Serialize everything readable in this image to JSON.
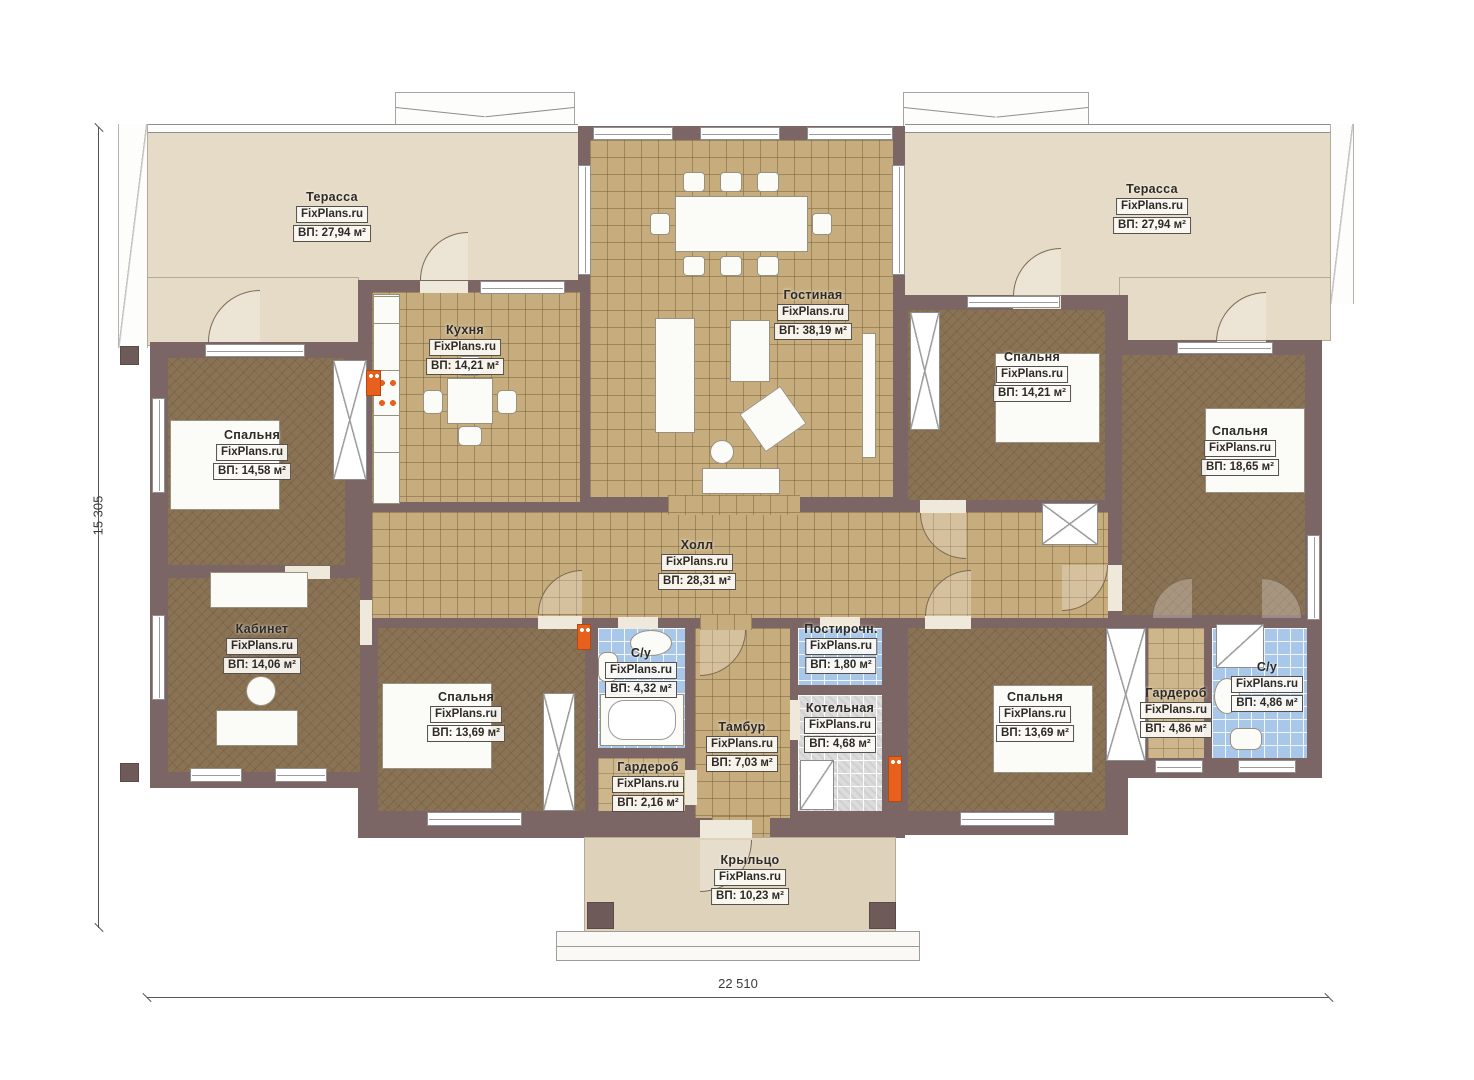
{
  "brand": "FixPlans.ru",
  "dimensions": {
    "width_label": "22 510",
    "height_label": "15 305"
  },
  "colors": {
    "wall": "#7c6565",
    "terrace_floor": "#e6dbc6",
    "tile_floor": "#c7ad7e",
    "room_floor": "#8a7254",
    "bathroom_tile": "#a9c7e8",
    "boiler_tile": "#dcdcdc",
    "radiator": "#e8601d"
  },
  "rooms": [
    {
      "id": "terrace-left",
      "name": "Терасса",
      "area": "ВП: 27,94 м²"
    },
    {
      "id": "terrace-right",
      "name": "Терасса",
      "area": "ВП: 27,94 м²"
    },
    {
      "id": "living",
      "name": "Гостиная",
      "area": "ВП: 38,19 м²"
    },
    {
      "id": "kitchen",
      "name": "Кухня",
      "area": "ВП: 14,21 м²"
    },
    {
      "id": "bedroom-left",
      "name": "Спальня",
      "area": "ВП: 14,58 м²"
    },
    {
      "id": "office",
      "name": "Кабинет",
      "area": "ВП: 14,06 м²"
    },
    {
      "id": "hall",
      "name": "Холл",
      "area": "ВП: 28,31 м²"
    },
    {
      "id": "bathroom-left",
      "name": "С/у",
      "area": "ВП: 4,32 м²"
    },
    {
      "id": "bedroom-bottom-left",
      "name": "Спальня",
      "area": "ВП: 13,69 м²"
    },
    {
      "id": "wardrobe-left",
      "name": "Гардероб",
      "area": "ВП: 2,16 м²"
    },
    {
      "id": "vestibule",
      "name": "Тамбур",
      "area": "ВП: 7,03 м²"
    },
    {
      "id": "laundry",
      "name": "Постирочн.",
      "area": "ВП: 1,80 м²"
    },
    {
      "id": "boiler",
      "name": "Котельная",
      "area": "ВП: 4,68 м²"
    },
    {
      "id": "bedroom-right",
      "name": "Спальня",
      "area": "ВП: 14,21 м²"
    },
    {
      "id": "bedroom-far-right",
      "name": "Спальня",
      "area": "ВП: 18,65 м²"
    },
    {
      "id": "bedroom-bottom-right",
      "name": "Спальня",
      "area": "ВП: 13,69 м²"
    },
    {
      "id": "wardrobe-right",
      "name": "Гардероб",
      "area": "ВП: 4,86 м²"
    },
    {
      "id": "bathroom-right",
      "name": "С/у",
      "area": "ВП: 4,86 м²"
    },
    {
      "id": "porch",
      "name": "Крыльцо",
      "area": "ВП: 10,23 м²"
    }
  ]
}
